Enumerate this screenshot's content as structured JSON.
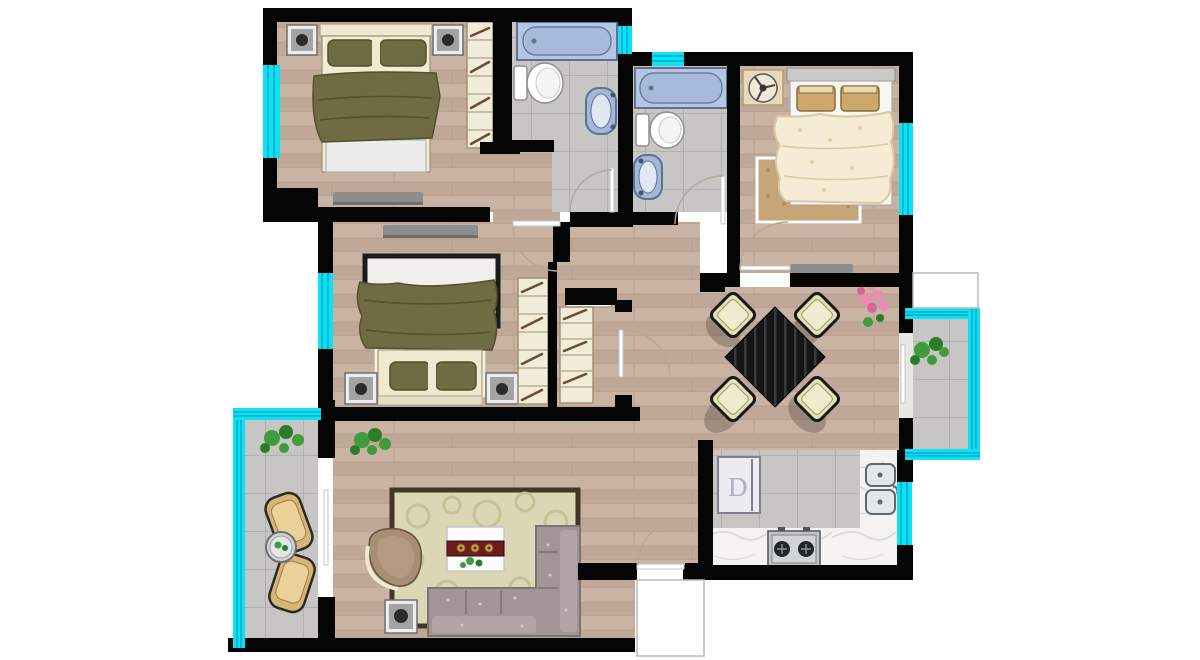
{
  "labels": {
    "fridge": "D"
  },
  "colors": {
    "wall": "#050505",
    "wood": "#c9b4a4",
    "wood2": "#bfa898",
    "wood_line": "#ae9988",
    "tile": "#c8c6c4",
    "tile_line": "#a9a7a5",
    "marble": "#f4f3f1",
    "vein": "#dbd8d4",
    "glass": "#0ce2f5",
    "glass_dark": "#00aec8",
    "tub": "#b4c6e1",
    "tub_inner": "#a6bbd9",
    "fixture_stroke": "#5f7090",
    "porcelain": "#ffffff",
    "porcelain_stroke": "#8f8f8f",
    "sink_blue": "#a3b8d8",
    "olive": "#6f6b43",
    "olive_dark": "#53502e",
    "bed_cream": "#f0e9ce",
    "bed_cream_stroke": "#a79e7c",
    "headboard_gray": "#c9c9c9",
    "blanket_cream": "#f6ecd6",
    "blanket_stroke": "#dcc9a4",
    "speckle": "#e8cba0",
    "pillow_tan": "#cda969",
    "pillow_tan_dark": "#8a6c3a",
    "rug_tan": "#c4a678",
    "rug_tan_dot": "#ad8f5e",
    "wardrobe": "#f1ebda",
    "wardrobe_stroke": "#a29272",
    "hanger": "#6d4c30",
    "nightstand": "#ededed",
    "nightstand_mid": "#a3a3a3",
    "nightstand_stroke": "#6f6f6f",
    "knob": "#2c2c2c",
    "console": "#8d8d8d",
    "console_dark": "#6e6e6e",
    "table_dark": "#151515",
    "table_streak": "#3a3a3a",
    "chair_cream": "#e7e0b0",
    "chair_stroke": "#181818",
    "sofa": "#a39595",
    "sofa_dark": "#7e7273",
    "sofa_light": "#b2a4a5",
    "sofa_speck": "#d4c8c9",
    "armchair": "#a88e76",
    "armchair_rim": "#f0ead0",
    "armchair_seat": "#b49a82",
    "rug_living": "#ddd6b4",
    "rug_border": "#443627",
    "rug_swirl": "#c9c095",
    "coffee_white": "#fcfcfc",
    "runner_red": "#6e1b1b",
    "plate_gold": "#c9a44a",
    "balcony_chair": "#d9b477",
    "balcony_chair_light": "#ecd09a",
    "plant_green": "#3f9b3b",
    "plant_dark": "#2c7c2a",
    "flower_pink": "#ec8ab4",
    "flower_dark": "#d86598",
    "appliance": "#ecebf2",
    "appliance_stroke": "#80808c",
    "fridge_letter": "#b2aec2",
    "stove": "#c2c5c7",
    "burner": "#20262b",
    "arc": "#b3a89b",
    "leaf": "#ffffff",
    "leaf_stroke": "#c4c4c4",
    "box_stroke": "#b9b9b9",
    "shadow": "rgba(70,60,50,0.32)"
  }
}
